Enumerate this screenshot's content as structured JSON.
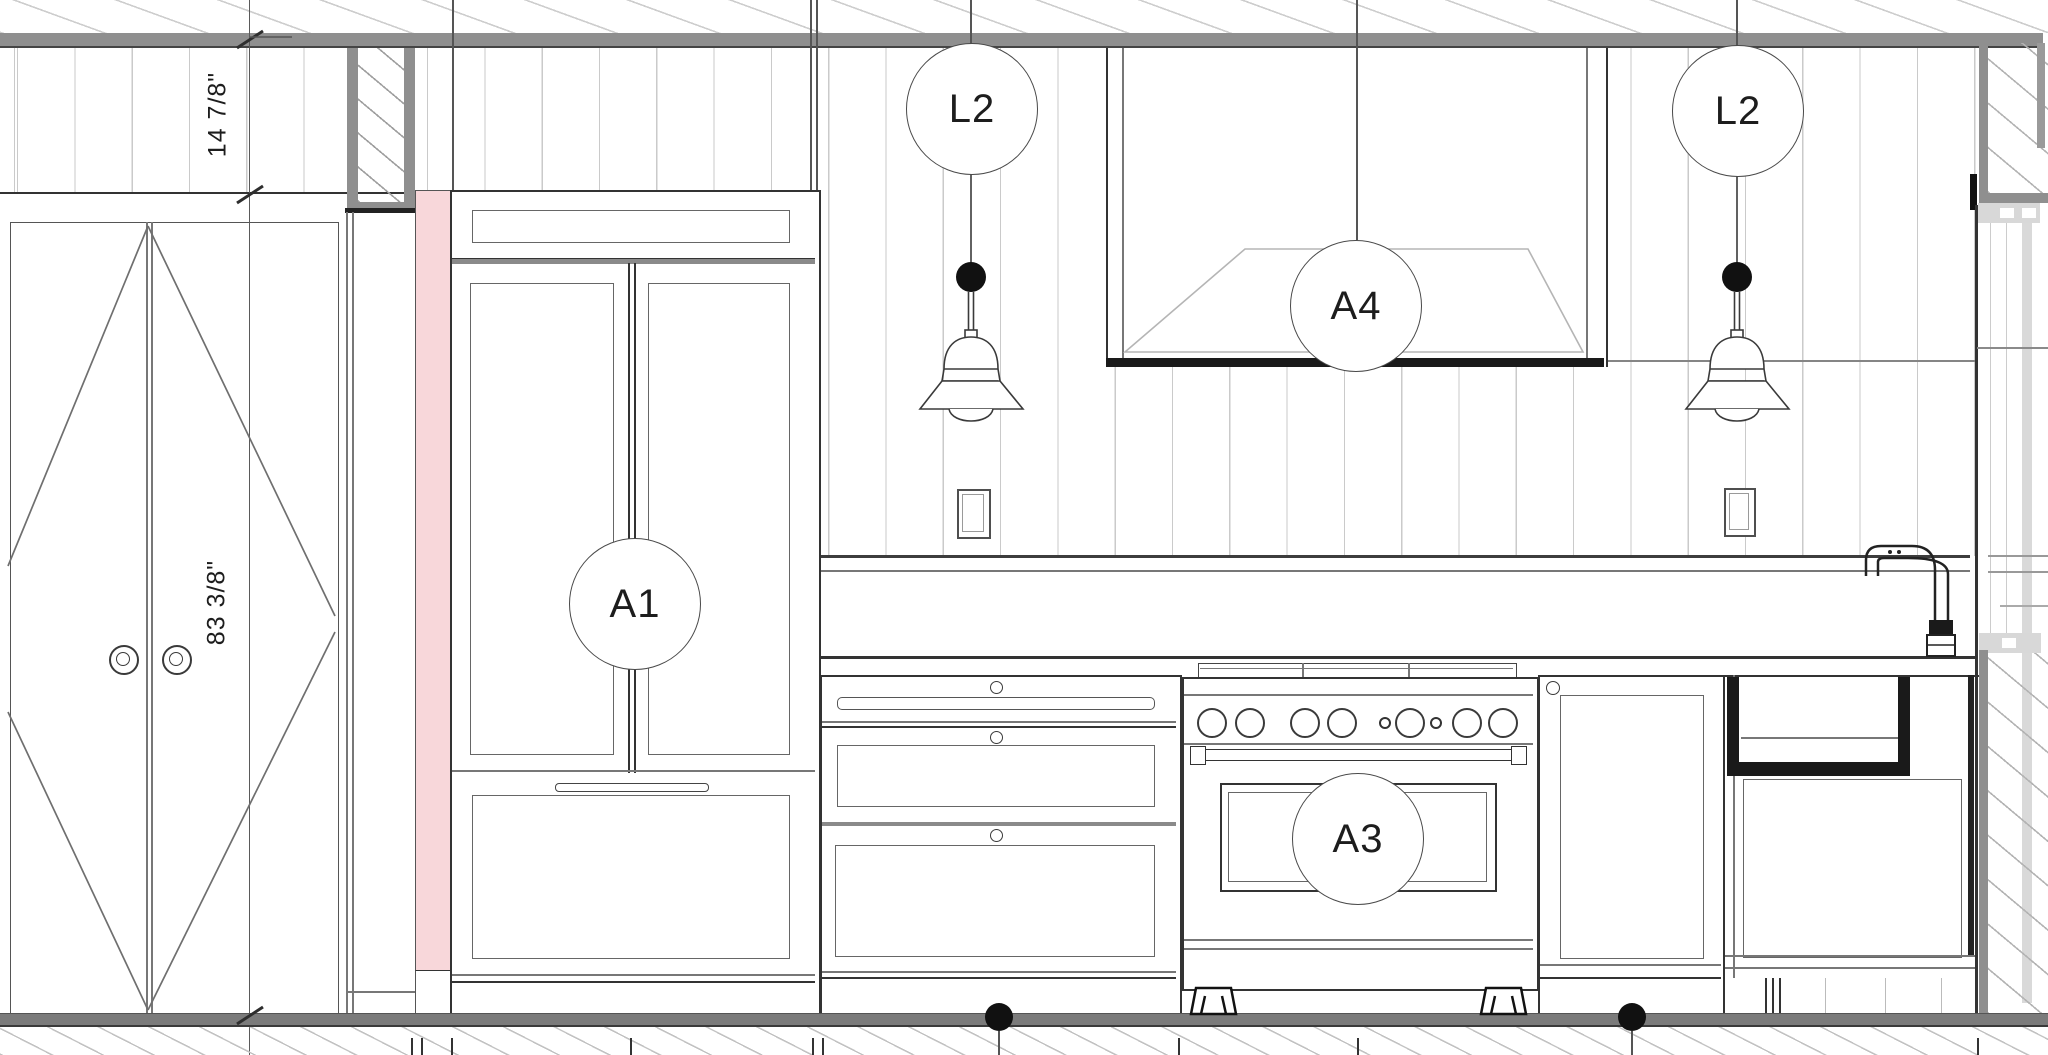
{
  "annotations": {
    "tag_pendant_left": "L2",
    "tag_pendant_right": "L2",
    "tag_hood": "A4",
    "tag_refrigerator": "A1",
    "tag_range": "A3",
    "dim_wall_upper": "14 7/8\"",
    "dim_wall_lower": "83 3/8\""
  },
  "colors": {
    "line_dark": "#333333",
    "line_black": "#1a1a1a",
    "line_medium": "#777777",
    "line_light": "#c9c9c9",
    "wall_section_gray": "#8f8f8f",
    "floor_gray": "#7b7b7b",
    "highlight_pink": "#f8d7da",
    "bracket_light": "#d8d8d8",
    "paper_white": "#ffffff"
  }
}
